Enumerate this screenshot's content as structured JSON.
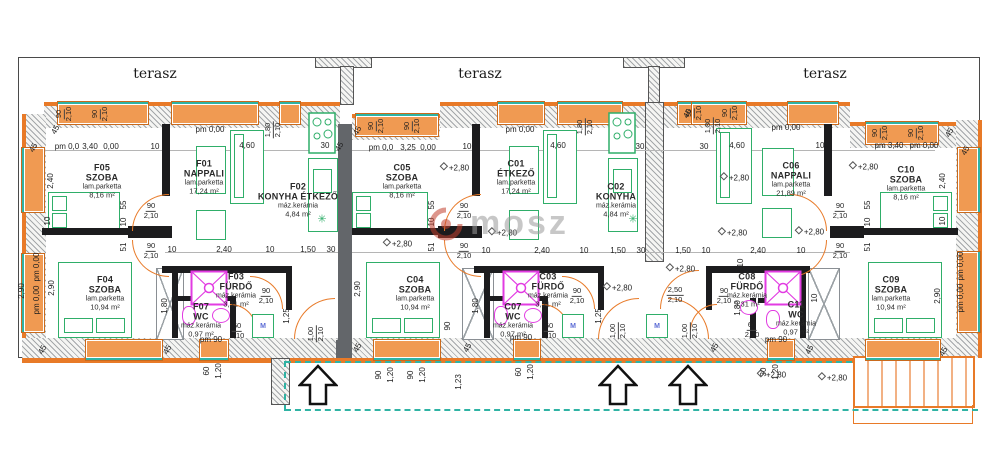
{
  "colors": {
    "wall_orange": "#e87a28",
    "window_fill": "#f09a52",
    "furniture_green": "#2fae69",
    "fixture_magenta": "#e23be2",
    "walkway_teal": "#2fb3a4",
    "party_wall_gray": "#63666a",
    "hatch_gray": "#9aa0a4",
    "line_black": "#1c1c1e"
  },
  "watermark": {
    "text": "mosz"
  },
  "fixtures": {
    "washing_machine_label": "M",
    "plant_symbol": "✳"
  },
  "terrace_labels": [
    {
      "t": "terasz",
      "x": 155,
      "y": 74
    },
    {
      "t": "terasz",
      "x": 480,
      "y": 74
    },
    {
      "t": "terasz",
      "x": 825,
      "y": 74
    }
  ],
  "rooms": [
    {
      "code": "F05",
      "name": "SZOBA",
      "finish": "lam.parketta",
      "area": "8,16 m²",
      "x": 102,
      "y": 181
    },
    {
      "code": "F01",
      "name": "NAPPALI",
      "finish": "lam.parketta",
      "area": "17,24 m²",
      "x": 204,
      "y": 177
    },
    {
      "code": "F02",
      "name": "KONYHA ÉTKEZŐ",
      "finish": "máz.kerámia",
      "area": "4,84 m²",
      "x": 298,
      "y": 200
    },
    {
      "code": "F04",
      "name": "SZOBA",
      "finish": "lam.parketta",
      "area": "10,94 m²",
      "x": 105,
      "y": 293
    },
    {
      "code": "F03",
      "name": "FÜRDŐ",
      "finish": "máz.kerámia",
      "area": "3,31 m²",
      "x": 236,
      "y": 290
    },
    {
      "code": "F07",
      "name": "WC",
      "finish": "máz.kerámia",
      "area": "0,97 m²",
      "x": 201,
      "y": 320
    },
    {
      "code": "C05",
      "name": "SZOBA",
      "finish": "lam.parketta",
      "area": "8,16 m²",
      "x": 402,
      "y": 181
    },
    {
      "code": "C01",
      "name": "ÉTKEZŐ",
      "finish": "lam.parketta",
      "area": "17,24 m²",
      "x": 516,
      "y": 177
    },
    {
      "code": "C02",
      "name": "KONYHA",
      "finish": "máz.kerámia",
      "area": "4,84 m²",
      "x": 616,
      "y": 200
    },
    {
      "code": "C04",
      "name": "SZOBA",
      "finish": "lam.parketta",
      "area": "10,94 m²",
      "x": 415,
      "y": 293
    },
    {
      "code": "C03",
      "name": "FÜRDŐ",
      "finish": "máz.kerámia",
      "area": "3,31 m²",
      "x": 548,
      "y": 290
    },
    {
      "code": "C07",
      "name": "WC",
      "finish": "máz.kerámia",
      "area": "0,97 m²",
      "x": 513,
      "y": 320
    },
    {
      "code": "C06",
      "name": "NAPPALI",
      "finish": "lam.parketta",
      "area": "21,89 m²",
      "x": 791,
      "y": 179
    },
    {
      "code": "C10",
      "name": "SZOBA",
      "finish": "lam.parketta",
      "area": "8,16 m²",
      "x": 906,
      "y": 183
    },
    {
      "code": "C09",
      "name": "SZOBA",
      "finish": "lam.parketta",
      "area": "10,94 m²",
      "x": 891,
      "y": 293
    },
    {
      "code": "C08",
      "name": "FÜRDŐ",
      "finish": "máz.kerámia",
      "area": "3,31 m²",
      "x": 747,
      "y": 290
    },
    {
      "code": "C11",
      "name": "WC",
      "finish": "máz.kerámia",
      "area": "0,97 m²",
      "x": 796,
      "y": 318
    }
  ],
  "level_marks": [
    {
      "t": "+2,80",
      "x": 455,
      "y": 168
    },
    {
      "t": "+2,80",
      "x": 398,
      "y": 244
    },
    {
      "t": "+2,80",
      "x": 503,
      "y": 233
    },
    {
      "t": "+2,80",
      "x": 618,
      "y": 288
    },
    {
      "t": "+2,80",
      "x": 681,
      "y": 269
    },
    {
      "t": "+2,80",
      "x": 735,
      "y": 178
    },
    {
      "t": "+2,80",
      "x": 733,
      "y": 233
    },
    {
      "t": "+2,80",
      "x": 810,
      "y": 232
    },
    {
      "t": "+2,80",
      "x": 864,
      "y": 167
    },
    {
      "t": "+2,80",
      "x": 772,
      "y": 375
    },
    {
      "t": "+2,80",
      "x": 833,
      "y": 378
    }
  ],
  "dim_labels": [
    {
      "t": "pm 0,00",
      "x": 210,
      "y": 130
    },
    {
      "t": "pm 0,00",
      "x": 520,
      "y": 130
    },
    {
      "t": "pm 0,00",
      "x": 786,
      "y": 128
    },
    {
      "t": "pm 0,0",
      "x": 67,
      "y": 147
    },
    {
      "t": "3,40",
      "x": 90,
      "y": 147
    },
    {
      "t": "0,00",
      "x": 111,
      "y": 147
    },
    {
      "t": "10",
      "x": 155,
      "y": 147
    },
    {
      "t": "4,60",
      "x": 247,
      "y": 146
    },
    {
      "t": "30",
      "x": 325,
      "y": 146
    },
    {
      "t": "45",
      "x": 34,
      "y": 148,
      "r": -60
    },
    {
      "t": "45",
      "x": 56,
      "y": 130,
      "r": -60
    },
    {
      "t": "45",
      "x": 340,
      "y": 147,
      "r": -60
    },
    {
      "t": "45",
      "x": 358,
      "y": 131,
      "r": -60
    },
    {
      "t": "pm 0,0",
      "x": 381,
      "y": 148
    },
    {
      "t": "3,25",
      "x": 408,
      "y": 148
    },
    {
      "t": "0,00",
      "x": 428,
      "y": 148
    },
    {
      "t": "10",
      "x": 467,
      "y": 147
    },
    {
      "t": "4,60",
      "x": 558,
      "y": 146
    },
    {
      "t": "30",
      "x": 640,
      "y": 147
    },
    {
      "t": "45",
      "x": 688,
      "y": 114,
      "r": -60
    },
    {
      "t": "30",
      "x": 704,
      "y": 147
    },
    {
      "t": "4,60",
      "x": 737,
      "y": 146
    },
    {
      "t": "10",
      "x": 820,
      "y": 146
    },
    {
      "t": "pm 3,40",
      "x": 889,
      "y": 146
    },
    {
      "t": "pm 0,00",
      "x": 924,
      "y": 146
    },
    {
      "t": "45",
      "x": 950,
      "y": 133,
      "r": -60
    },
    {
      "t": "45",
      "x": 966,
      "y": 151,
      "r": -60
    },
    {
      "t": "10",
      "x": 172,
      "y": 250
    },
    {
      "t": "2,40",
      "x": 224,
      "y": 250
    },
    {
      "t": "10",
      "x": 270,
      "y": 250
    },
    {
      "t": "1,50",
      "x": 308,
      "y": 250
    },
    {
      "t": "30",
      "x": 331,
      "y": 250
    },
    {
      "t": "10",
      "x": 486,
      "y": 251
    },
    {
      "t": "2,40",
      "x": 542,
      "y": 251
    },
    {
      "t": "10",
      "x": 584,
      "y": 251
    },
    {
      "t": "1,50",
      "x": 618,
      "y": 251
    },
    {
      "t": "30",
      "x": 641,
      "y": 251
    },
    {
      "t": "1,50",
      "x": 683,
      "y": 251
    },
    {
      "t": "10",
      "x": 706,
      "y": 251
    },
    {
      "t": "2,40",
      "x": 758,
      "y": 251
    },
    {
      "t": "10",
      "x": 801,
      "y": 251
    },
    {
      "t": "55",
      "x": 124,
      "y": 205,
      "r": -90
    },
    {
      "t": "10",
      "x": 124,
      "y": 222,
      "r": -90
    },
    {
      "t": "51",
      "x": 124,
      "y": 247,
      "r": -90
    },
    {
      "t": "55",
      "x": 432,
      "y": 205,
      "r": -90
    },
    {
      "t": "10",
      "x": 432,
      "y": 222,
      "r": -90
    },
    {
      "t": "51",
      "x": 432,
      "y": 247,
      "r": -90
    },
    {
      "t": "55",
      "x": 868,
      "y": 205,
      "r": -90
    },
    {
      "t": "10",
      "x": 868,
      "y": 222,
      "r": -90
    },
    {
      "t": "51",
      "x": 868,
      "y": 247,
      "r": -90
    },
    {
      "t": "10",
      "x": 741,
      "y": 263,
      "r": -90
    },
    {
      "t": "90",
      "x": 448,
      "y": 326,
      "r": -90
    },
    {
      "t": "10",
      "x": 815,
      "y": 298,
      "r": -90
    },
    {
      "t": "2,40",
      "x": 51,
      "y": 181,
      "r": -90
    },
    {
      "t": "10",
      "x": 48,
      "y": 221,
      "r": -90
    },
    {
      "t": "pm 0,00",
      "x": 37,
      "y": 267,
      "r": -90
    },
    {
      "t": "pm 0,00",
      "x": 37,
      "y": 300,
      "r": -90
    },
    {
      "t": "2,90",
      "x": 22,
      "y": 291,
      "r": -90
    },
    {
      "t": "2,90",
      "x": 52,
      "y": 288,
      "r": -90
    },
    {
      "t": "2,40",
      "x": 943,
      "y": 181,
      "r": -90
    },
    {
      "t": "10",
      "x": 943,
      "y": 221,
      "r": -90
    },
    {
      "t": "2,90",
      "x": 938,
      "y": 296,
      "r": -90
    },
    {
      "t": "pm 0,00",
      "x": 961,
      "y": 266,
      "r": -90
    },
    {
      "t": "pm 0,00",
      "x": 961,
      "y": 298,
      "r": -90
    },
    {
      "t": "2,90",
      "x": 358,
      "y": 289,
      "r": -90
    },
    {
      "t": "1,80",
      "x": 165,
      "y": 306,
      "r": -90
    },
    {
      "t": "1,80",
      "x": 476,
      "y": 306,
      "r": -90
    },
    {
      "t": "1,80",
      "x": 738,
      "y": 308,
      "r": -90
    },
    {
      "t": "1,25",
      "x": 287,
      "y": 316,
      "r": -90
    },
    {
      "t": "1,25",
      "x": 599,
      "y": 316,
      "r": -90
    },
    {
      "t": "pm 90",
      "x": 211,
      "y": 340
    },
    {
      "t": "pm 90",
      "x": 521,
      "y": 338
    },
    {
      "t": "pm 90",
      "x": 776,
      "y": 340
    },
    {
      "t": "60",
      "x": 207,
      "y": 371,
      "r": -90
    },
    {
      "t": "1,20",
      "x": 219,
      "y": 371,
      "r": -90
    },
    {
      "t": "90",
      "x": 379,
      "y": 375,
      "r": -90
    },
    {
      "t": "1,20",
      "x": 391,
      "y": 375,
      "r": -90
    },
    {
      "t": "90",
      "x": 411,
      "y": 375,
      "r": -90
    },
    {
      "t": "1,20",
      "x": 423,
      "y": 375,
      "r": -90
    },
    {
      "t": "1,23",
      "x": 459,
      "y": 382,
      "r": -90
    },
    {
      "t": "60",
      "x": 519,
      "y": 372,
      "r": -90
    },
    {
      "t": "1,20",
      "x": 531,
      "y": 372,
      "r": -90
    },
    {
      "t": "30",
      "x": 764,
      "y": 372,
      "r": -90
    },
    {
      "t": "1,20",
      "x": 776,
      "y": 372,
      "r": -90
    },
    {
      "t": "45",
      "x": 43,
      "y": 350,
      "r": -60
    },
    {
      "t": "45",
      "x": 168,
      "y": 350,
      "r": -60
    },
    {
      "t": "45",
      "x": 358,
      "y": 348,
      "r": -60
    },
    {
      "t": "45",
      "x": 468,
      "y": 348,
      "r": -60
    },
    {
      "t": "45",
      "x": 715,
      "y": 348,
      "r": -60
    },
    {
      "t": "45",
      "x": 810,
      "y": 350,
      "r": -60
    },
    {
      "t": "45",
      "x": 944,
      "y": 352,
      "r": -60
    }
  ],
  "frac_labels": [
    {
      "top": "90",
      "bot": "2,10",
      "x": 64,
      "y": 114,
      "r": -90
    },
    {
      "top": "90",
      "bot": "2,10",
      "x": 100,
      "y": 114,
      "r": -90
    },
    {
      "top": "90",
      "bot": "2,10",
      "x": 376,
      "y": 126,
      "r": -90
    },
    {
      "top": "90",
      "bot": "2,10",
      "x": 412,
      "y": 126,
      "r": -90
    },
    {
      "top": "90",
      "bot": "2,10",
      "x": 694,
      "y": 113,
      "r": -90
    },
    {
      "top": "90",
      "bot": "2,10",
      "x": 730,
      "y": 113,
      "r": -90
    },
    {
      "top": "90",
      "bot": "2,10",
      "x": 880,
      "y": 133,
      "r": -90
    },
    {
      "top": "90",
      "bot": "2,10",
      "x": 916,
      "y": 133,
      "r": -90
    },
    {
      "top": "1,80",
      "bot": "2,10",
      "x": 273,
      "y": 130,
      "r": -90
    },
    {
      "top": "1,80",
      "bot": "2,10",
      "x": 585,
      "y": 127,
      "r": -90
    },
    {
      "top": "1,80",
      "bot": "2,10",
      "x": 713,
      "y": 126,
      "r": -90
    },
    {
      "top": "90",
      "bot": "2,10",
      "x": 151,
      "y": 211
    },
    {
      "top": "90",
      "bot": "2,10",
      "x": 151,
      "y": 251
    },
    {
      "top": "90",
      "bot": "2,10",
      "x": 464,
      "y": 211
    },
    {
      "top": "90",
      "bot": "2,10",
      "x": 464,
      "y": 251
    },
    {
      "top": "90",
      "bot": "2,10",
      "x": 840,
      "y": 211
    },
    {
      "top": "90",
      "bot": "2,10",
      "x": 840,
      "y": 251
    },
    {
      "top": "90",
      "bot": "2,10",
      "x": 266,
      "y": 296
    },
    {
      "top": "90",
      "bot": "2,10",
      "x": 577,
      "y": 296
    },
    {
      "top": "90",
      "bot": "2,10",
      "x": 724,
      "y": 296
    },
    {
      "top": "60",
      "bot": "2,10",
      "x": 237,
      "y": 331
    },
    {
      "top": "60",
      "bot": "2,10",
      "x": 549,
      "y": 331
    },
    {
      "top": "60",
      "bot": "2,10",
      "x": 752,
      "y": 330
    },
    {
      "top": "2,50",
      "bot": "2,10",
      "x": 675,
      "y": 295
    },
    {
      "top": "1,00",
      "bot": "2,10",
      "x": 316,
      "y": 334,
      "r": -90
    },
    {
      "top": "1,00",
      "bot": "2,10",
      "x": 618,
      "y": 331,
      "r": -90
    },
    {
      "top": "1,00",
      "bot": "2,10",
      "x": 690,
      "y": 331,
      "r": -90
    }
  ]
}
